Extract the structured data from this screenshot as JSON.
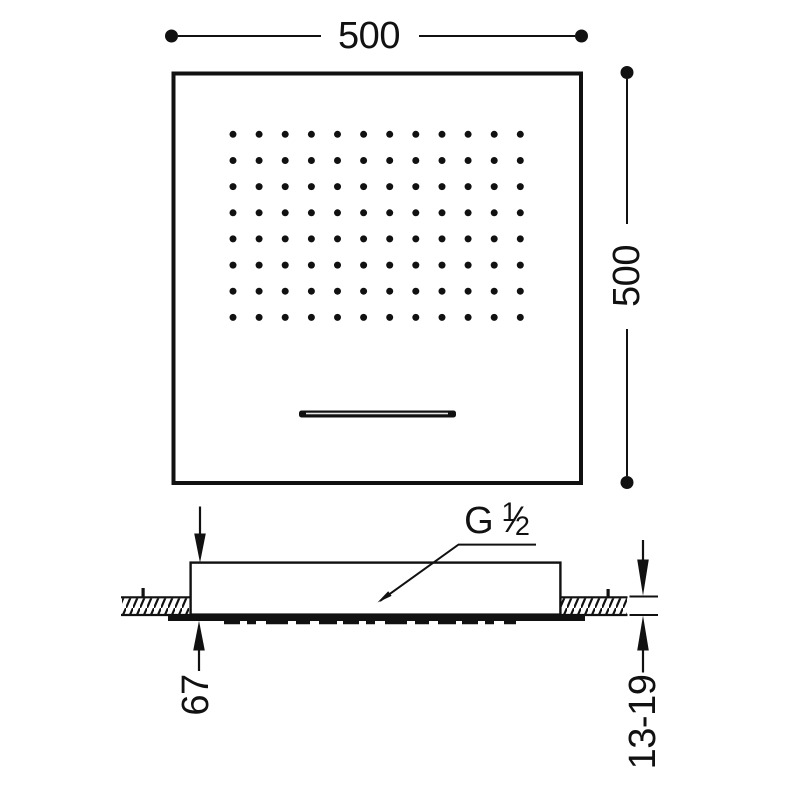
{
  "colors": {
    "ink": "#111111",
    "background": "#ffffff"
  },
  "drawing": {
    "plan_view": {
      "width_dimension_label": "500",
      "height_dimension_label": "500",
      "nozzle_grid": {
        "columns": 12,
        "rows": 8
      }
    },
    "section_view": {
      "total_height_label": "67",
      "ceiling_thickness_label": "13-19",
      "thread_label": {
        "full": "G 1/2",
        "prefix": "G",
        "numerator": "1",
        "fraction_slash": "∕",
        "denominator": "2"
      }
    }
  }
}
